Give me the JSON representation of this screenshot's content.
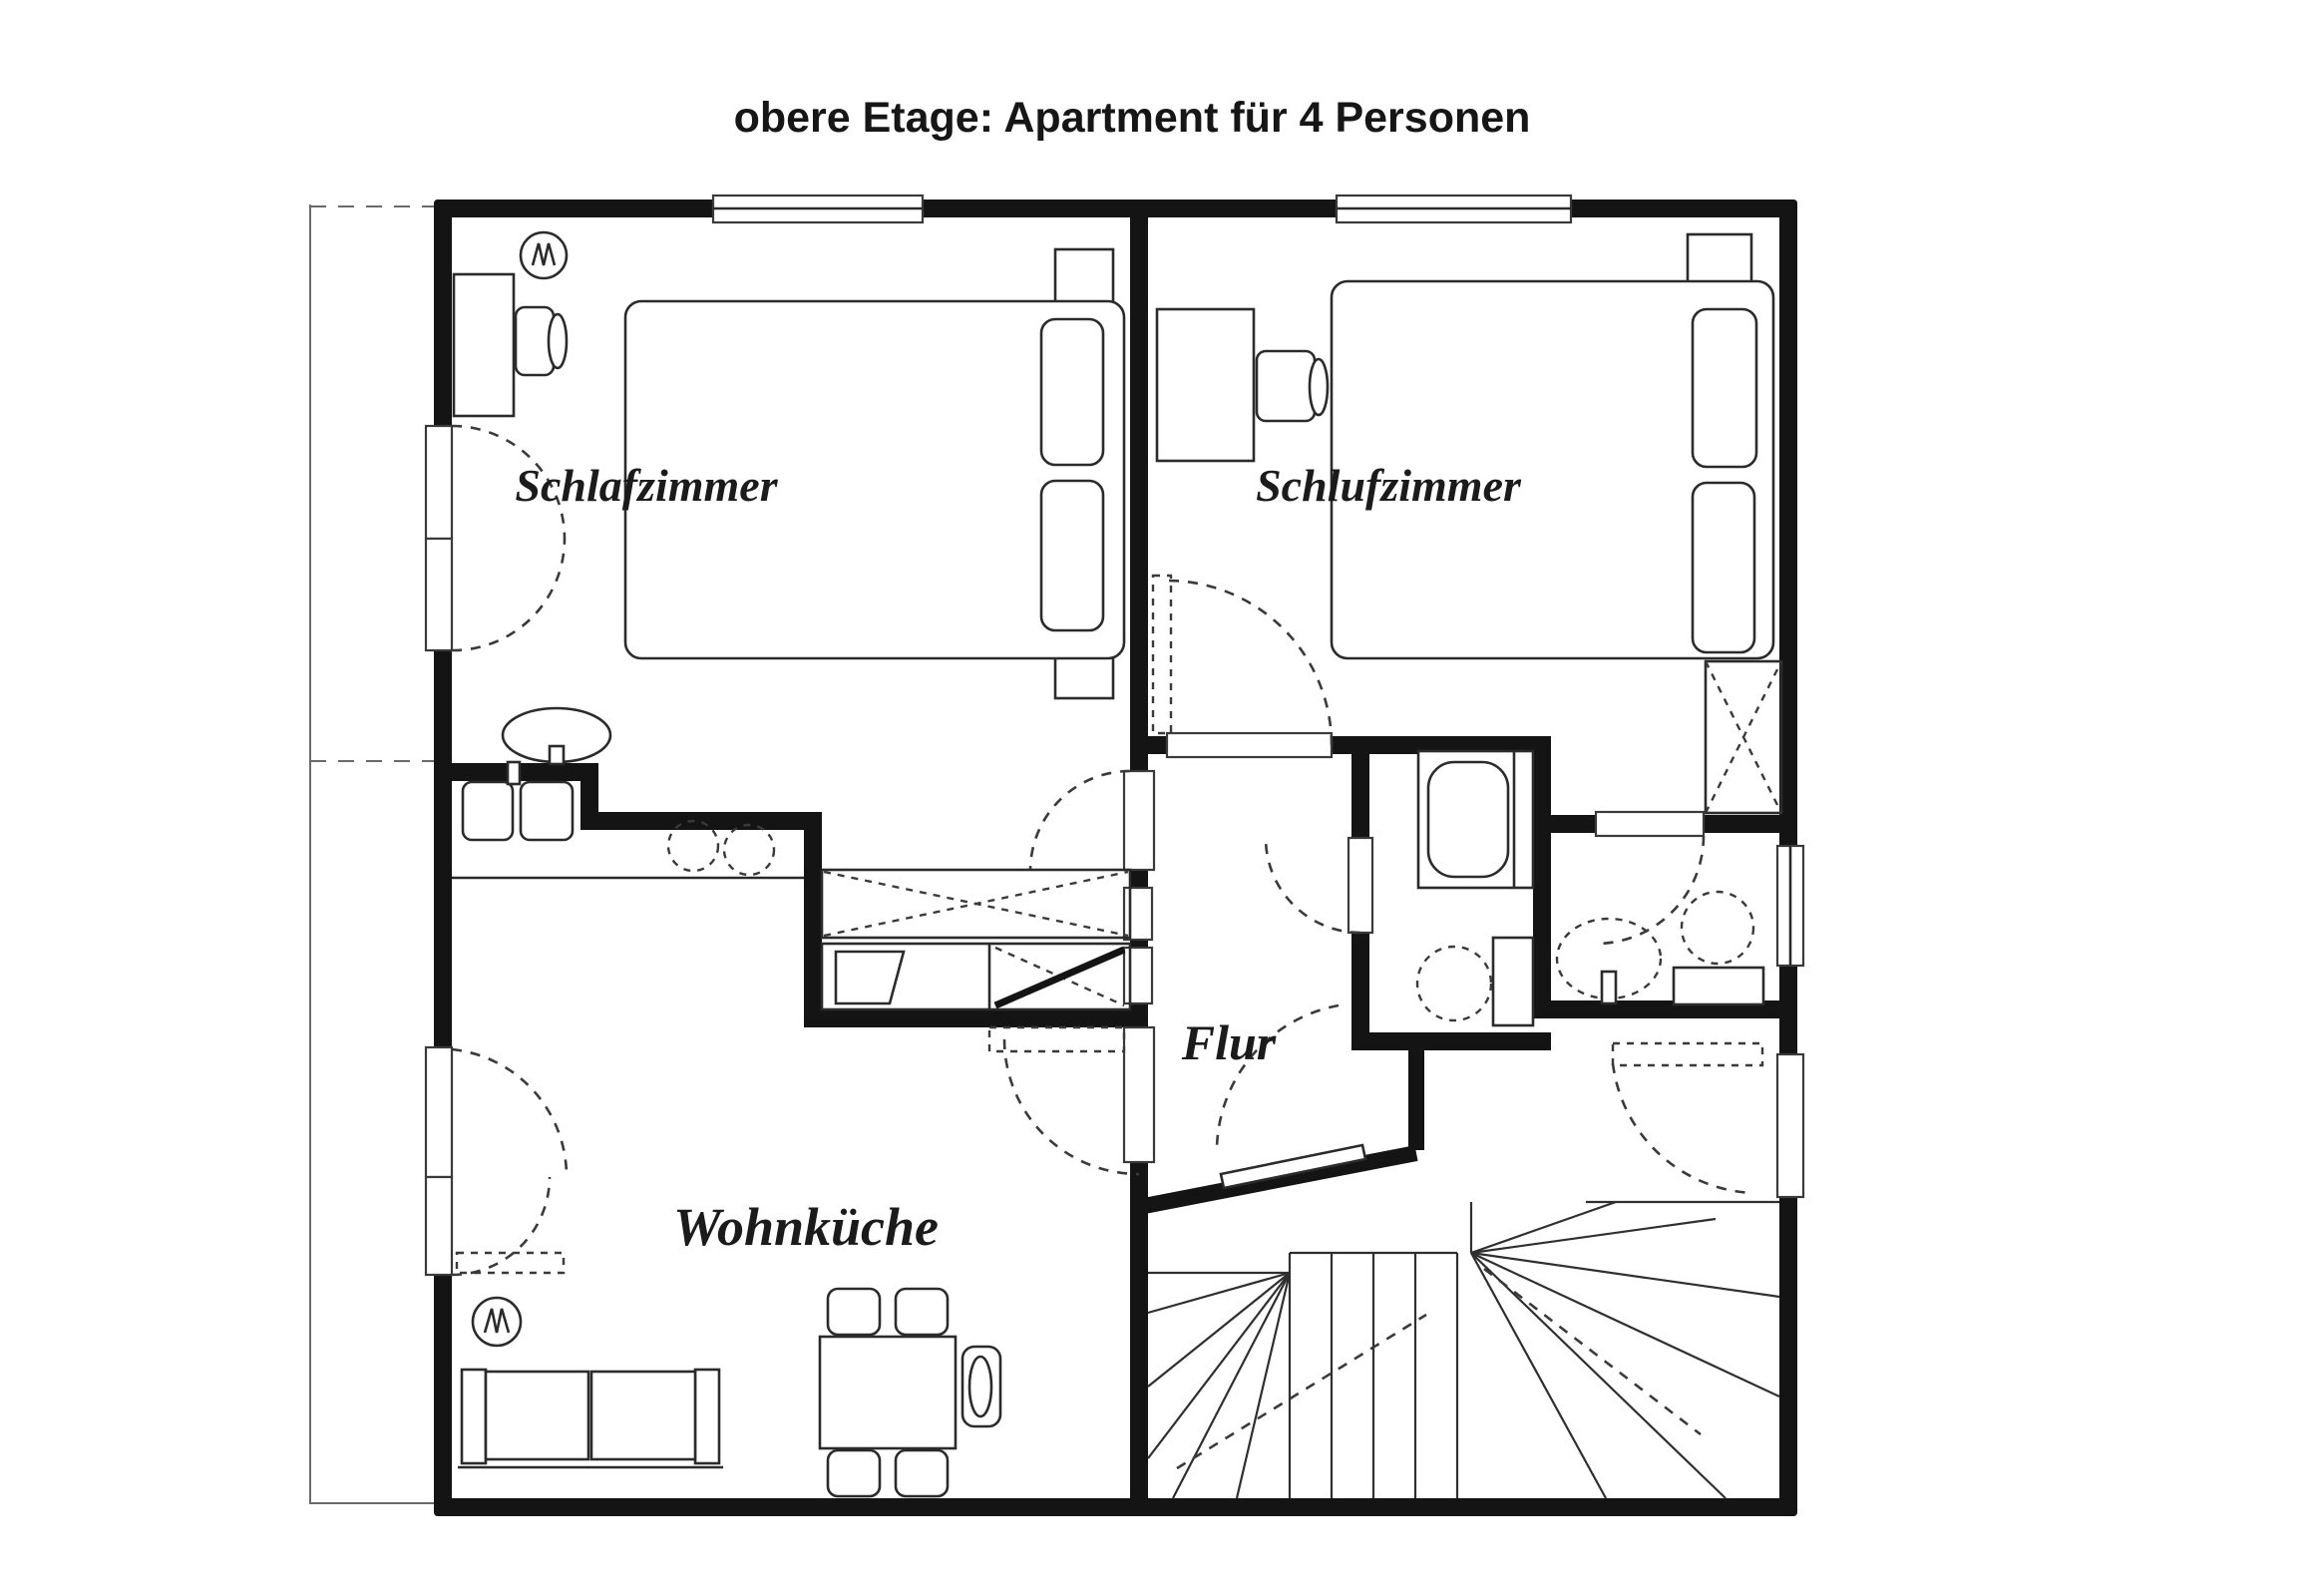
{
  "title": "obere Etage: Apartment für 4 Personen",
  "rooms": {
    "bedroom_left": "Schlafzimmer",
    "bedroom_right": "Schlufzimmer",
    "kitchen": "Wohnküche",
    "hallway": "Flur"
  },
  "colors": {
    "wall": "#141414",
    "line": "#2b2b2b",
    "background": "#ffffff"
  }
}
